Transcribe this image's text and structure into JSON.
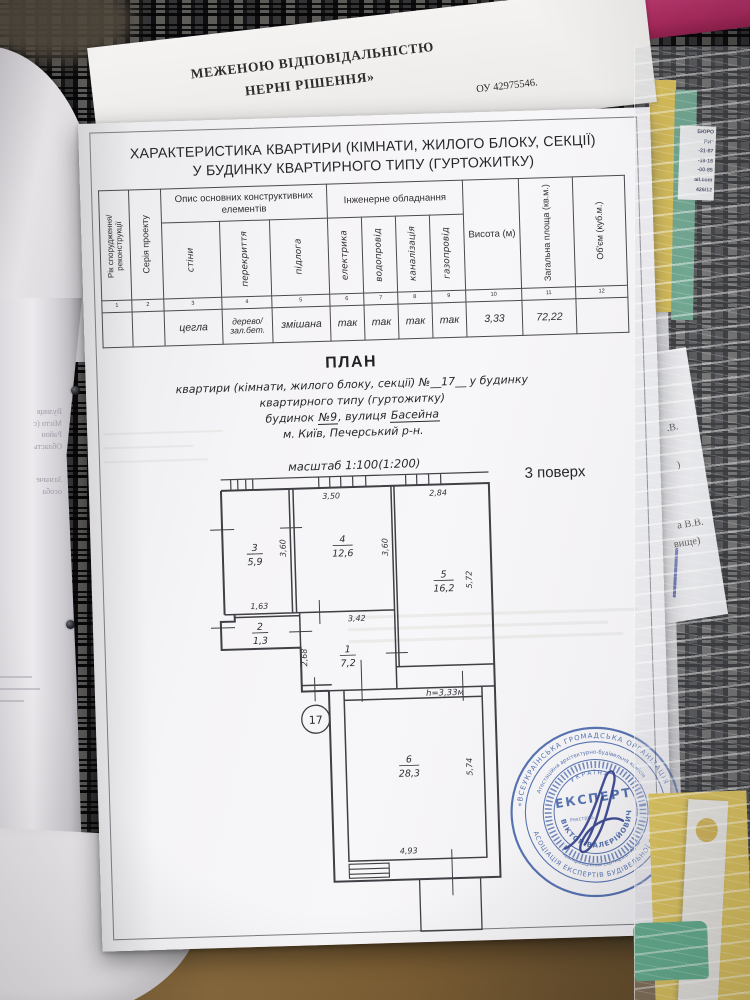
{
  "background": {
    "top_sheet": {
      "line1": "МЕЖЕНОЮ ВІДПОВІДАЛЬНІСТЮ",
      "line2": "НЕРНІ РІШЕННЯ»",
      "line3": "ОУ 42975546."
    },
    "right_sheet": {
      "f1": ".В.",
      "f2": ")",
      "f3": "а В.В.",
      "f4": "вище)"
    },
    "label_card": {
      "l1": "БЮРО",
      "l2": "РИ\"",
      "l3": "-31-87",
      "l4": "-19-16",
      "l5": "-00-85",
      "l6": "ail.com",
      "l7": "426/12"
    },
    "left_page": {
      "big": "ТО",
      "f1": "Вулиця",
      "f2": "Місто (с",
      "f3": "Район",
      "f4": "Область",
      "f5": "Зазначе",
      "f6": "особа"
    }
  },
  "document": {
    "title_line1": "ХАРАКТЕРИСТИКА КВАРТИРИ (КІМНАТИ, ЖИЛОГО БЛОКУ, СЕКЦІЇ)",
    "title_line2": "У БУДИНКУ КВАРТИРНОГО ТИПУ (ГУРТОЖИТКУ)",
    "table": {
      "group_desc": "Опис основних конструктивних елементів",
      "group_eng": "Інженерне обладнання",
      "col_year": "Рік спорудження/ реконструкції",
      "col_series": "Серія проекту",
      "col_walls": "стіни",
      "col_overlap": "перекриття",
      "col_floor": "підлога",
      "col_electric": "електрика",
      "col_water": "водопровід",
      "col_sewer": "каналізація",
      "col_gas": "газопровід",
      "col_height": "Висота (м)",
      "col_area": "Загальна площа (кв.м.)",
      "col_volume": "Об'єм (куб.м.)",
      "numbers": [
        "1",
        "2",
        "3",
        "4",
        "5",
        "6",
        "7",
        "8",
        "9",
        "10",
        "11",
        "12"
      ],
      "values": {
        "year": "",
        "series": "",
        "walls": "цегла",
        "overlap": "дерево/ зал.бет.",
        "floor": "змішана",
        "electric": "так",
        "water": "так",
        "sewer": "так",
        "gas": "так",
        "height": "3,33",
        "area": "72,22",
        "volume": ""
      }
    }
  },
  "plan": {
    "heading": "ПЛАН",
    "line1": "квартири (кімнати, жилого блоку, секції) №__17__ у будинку",
    "line2": "квартирного типу (гуртожитку)",
    "line3_prefix": "будинок ",
    "line3_num": "№9",
    "line3_mid": ", вулиця ",
    "line3_street": "Басейна",
    "line4": "м. Київ, Печерський р-н.",
    "scale": "масштаб 1:100(1:200)",
    "floor": "3 поверх",
    "circle_label": "17",
    "height_note": "h=3,33м",
    "rooms": [
      {
        "num": "3",
        "area": "5,9"
      },
      {
        "num": "4",
        "area": "12,6"
      },
      {
        "num": "5",
        "area": "16,2"
      },
      {
        "num": "2",
        "area": "1,3"
      },
      {
        "num": "1",
        "area": "7,2"
      },
      {
        "num": "6",
        "area": "28,3"
      }
    ],
    "dims": {
      "top4": "3,50",
      "top5": "2,84",
      "side3": "3,60",
      "side4": "3,60",
      "side5": "5,72",
      "bottom3": "1,63",
      "top1": "3,42",
      "side1": "2,68",
      "side6": "5,74",
      "bottom6": "4,93"
    }
  },
  "stamp": {
    "ring_top": "«ВСЕУКРАЇНСЬКА ГРОМАДСЬКА ОРГАНІЗАЦІЯ",
    "ring_bottom": "АСОЦІАЦІЯ ЕКСПЕРТІВ БУДІВЕЛЬНОЇ ГАЛУЗІ»",
    "ring2_top": "Атестаційна архітектурно-будівельна комісія",
    "ring2_bottom": "кваліфікаційний сертифікат АЕ №",
    "country": "УКРАЇНА",
    "title": "ЕКСПЕРТ",
    "small1": "Реєстрац.",
    "name": "ВІКТОР ВАЛЕРІЙОВИЧ",
    "color": "#4c6db2"
  }
}
